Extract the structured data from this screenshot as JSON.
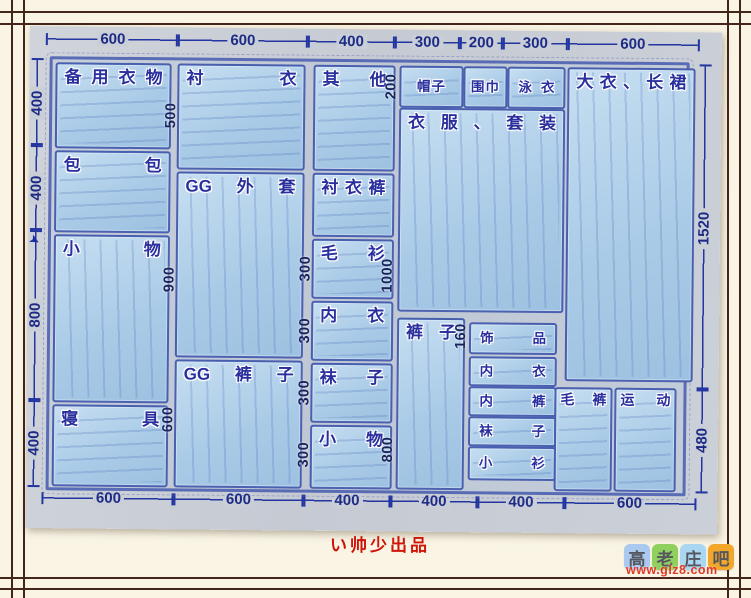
{
  "dims": {
    "top": [
      "600",
      "600",
      "400",
      "300",
      "200",
      "300",
      "600"
    ],
    "bottom": [
      "600",
      "600",
      "400",
      "400",
      "400",
      "600"
    ],
    "left": [
      "400",
      "400",
      "800",
      "400"
    ],
    "right": [
      "1520",
      "480"
    ],
    "inner": {
      "shirts_h": "500",
      "gg_coats_h": "900",
      "gg_pants_h": "600",
      "sweaters_h": "300",
      "underwear_h": "300",
      "socks_h": "300",
      "small_h": "300",
      "hats_h": "200",
      "suits_h": "1000",
      "pants_h": "800",
      "accessories_h": "160"
    }
  },
  "boxes": {
    "spare": {
      "label": "备用衣物"
    },
    "bags": {
      "label": "包包"
    },
    "small_left": {
      "label": "小物"
    },
    "bedding": {
      "label": "寝具"
    },
    "shirts": {
      "label": "衬衣"
    },
    "gg_coats": {
      "label": "GG外套"
    },
    "gg_pants": {
      "label": "GG裤子"
    },
    "others": {
      "label": "其他"
    },
    "shirt_pants": {
      "label": "衬衣裤"
    },
    "sweaters": {
      "label": "毛衫"
    },
    "underwear_mid": {
      "label": "内衣"
    },
    "socks_mid": {
      "label": "袜子"
    },
    "small_mid": {
      "label": "小物"
    },
    "hats": {
      "label": "帽子"
    },
    "scarves": {
      "label": "围巾"
    },
    "swimwear": {
      "label": "泳衣"
    },
    "suits": {
      "label": "衣服、套装"
    },
    "pants": {
      "label": "裤子"
    },
    "accessories": {
      "label": "饰品"
    },
    "underwear_drawer": {
      "label": "内衣"
    },
    "underpants_drawer": {
      "label": "内裤"
    },
    "socks_drawer": {
      "label": "袜子"
    },
    "tops_drawer": {
      "label": "小衫"
    },
    "coats_skirts": {
      "label": "大衣、长裙"
    },
    "wool_pants": {
      "label": "毛裤"
    },
    "sports": {
      "label": "运动"
    }
  },
  "watermarks": {
    "producer": "い帅少出品",
    "site_chars": [
      "高",
      "老",
      "庄",
      "吧"
    ],
    "site_url": "www.glz8.com"
  },
  "colors": {
    "drawing_blue": "#3f55ad",
    "label_blue": "#2a2f9e",
    "dimension_navy": "#1d2a86",
    "paper_gray": "#c9cdd5",
    "frame_brown": "#44251a",
    "background_cream": "#f9f4e4",
    "watermark_red": "#cf1408",
    "tile_colors": [
      "#a9c9ef",
      "#8fd05e",
      "#a9d6f0",
      "#f2a62a"
    ]
  }
}
